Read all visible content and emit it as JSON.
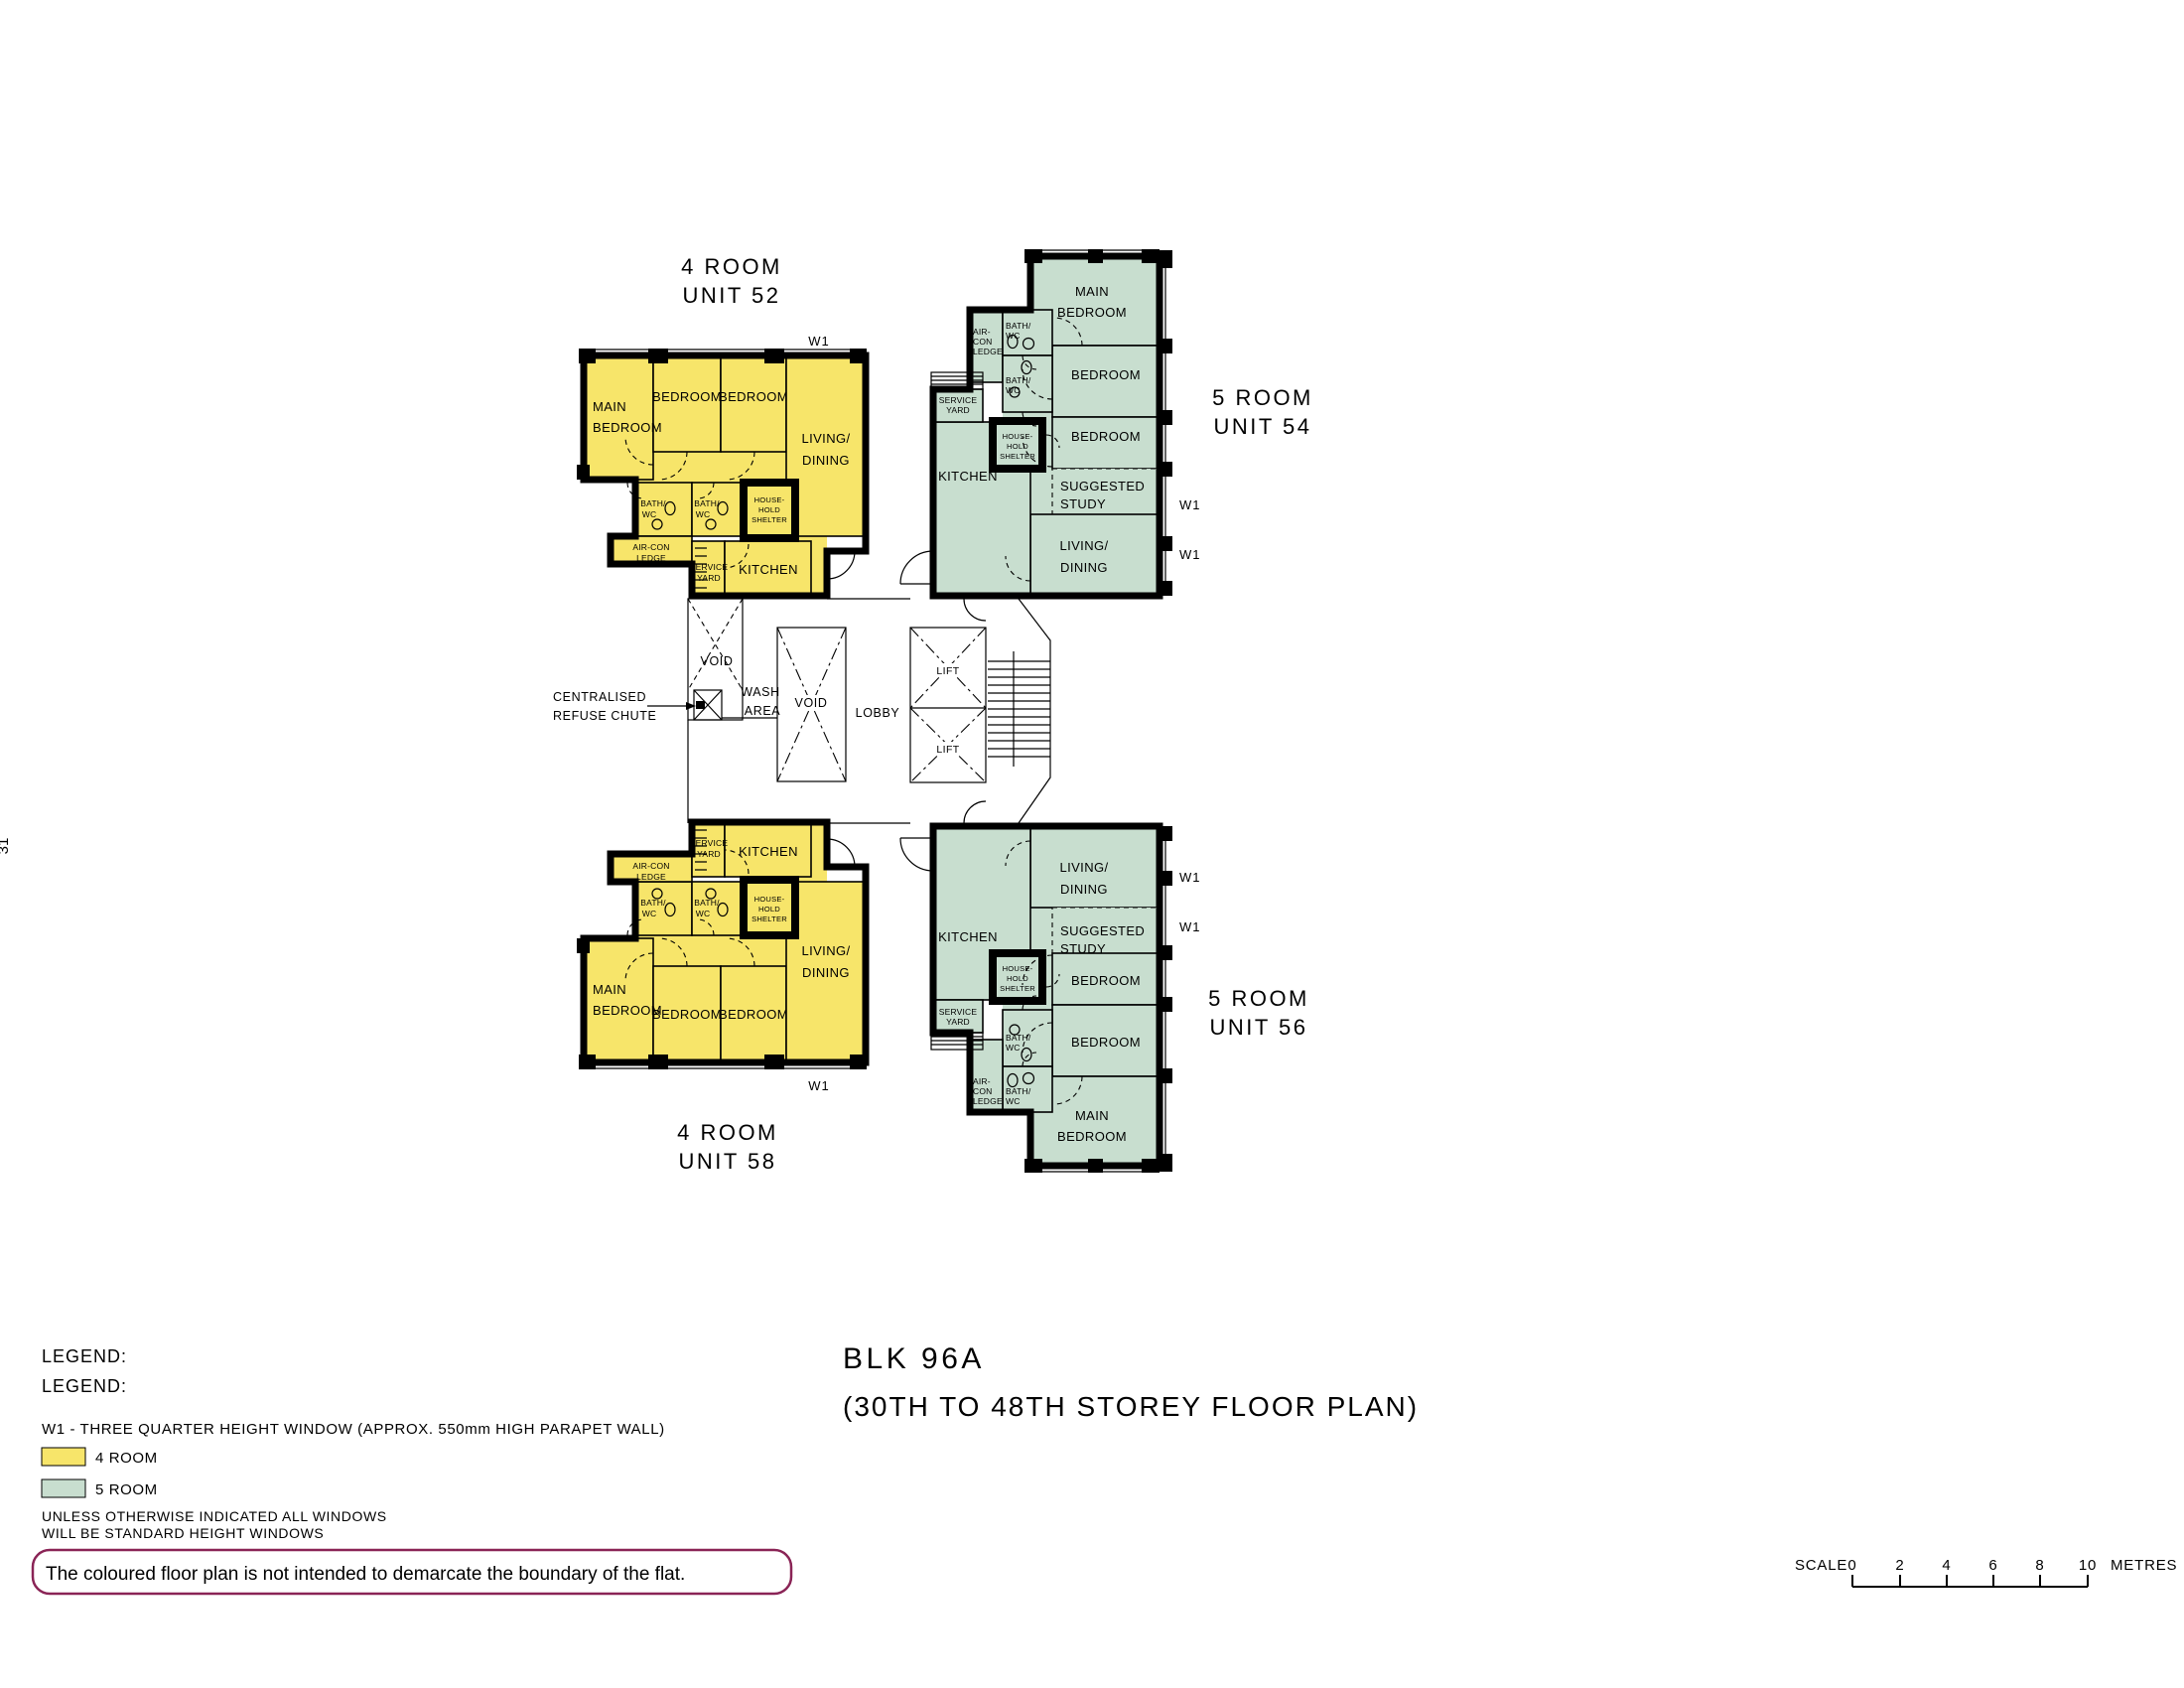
{
  "page": {
    "side_number": "31"
  },
  "colors": {
    "four_room": "#F7E56A",
    "five_room": "#C8DECF",
    "wall": "#000000",
    "note_border": "#8A2456"
  },
  "units": {
    "u52": {
      "type": "4 ROOM",
      "number": "UNIT 52",
      "window_tag": "W1",
      "rooms": {
        "main_bedroom": [
          "MAIN",
          "BEDROOM"
        ],
        "bedroom_a": "BEDROOM",
        "bedroom_b": "BEDROOM",
        "living": [
          "LIVING/",
          "DINING"
        ],
        "bath_a": [
          "BATH/",
          "WC"
        ],
        "bath_b": [
          "BATH/",
          "WC"
        ],
        "aircon": [
          "AIR-CON",
          "LEDGE"
        ],
        "shelter": [
          "HOUSE-",
          "HOLD",
          "SHELTER"
        ],
        "service": [
          "SERVICE",
          "YARD"
        ],
        "kitchen": "KITCHEN"
      }
    },
    "u58": {
      "type": "4 ROOM",
      "number": "UNIT 58",
      "window_tag": "W1",
      "rooms": {
        "main_bedroom": [
          "MAIN",
          "BEDROOM"
        ],
        "bedroom_a": "BEDROOM",
        "bedroom_b": "BEDROOM",
        "living": [
          "LIVING/",
          "DINING"
        ],
        "bath_a": [
          "BATH/",
          "WC"
        ],
        "bath_b": [
          "BATH/",
          "WC"
        ],
        "aircon": [
          "AIR-CON",
          "LEDGE"
        ],
        "shelter": [
          "HOUSE-",
          "HOLD",
          "SHELTER"
        ],
        "service": [
          "SERVICE",
          "YARD"
        ],
        "kitchen": "KITCHEN"
      }
    },
    "u54": {
      "type": "5 ROOM",
      "number": "UNIT 54",
      "window_tag_a": "W1",
      "window_tag_b": "W1",
      "rooms": {
        "main_bedroom": [
          "MAIN",
          "BEDROOM"
        ],
        "bedroom_a": "BEDROOM",
        "bedroom_b": "BEDROOM",
        "study": [
          "SUGGESTED",
          "STUDY"
        ],
        "living": [
          "LIVING/",
          "DINING"
        ],
        "kitchen": "KITCHEN",
        "service": [
          "SERVICE",
          "YARD"
        ],
        "aircon": [
          "AIR-",
          "CON",
          "LEDGE"
        ],
        "bath_a": [
          "BATH/",
          "WC"
        ],
        "bath_b": [
          "BATH/",
          "WC"
        ],
        "shelter": [
          "HOUSE-",
          "HOLD",
          "SHELTER"
        ]
      }
    },
    "u56": {
      "type": "5 ROOM",
      "number": "UNIT 56",
      "window_tag_a": "W1",
      "window_tag_b": "W1",
      "rooms": {
        "main_bedroom": [
          "MAIN",
          "BEDROOM"
        ],
        "bedroom_a": "BEDROOM",
        "bedroom_b": "BEDROOM",
        "study": [
          "SUGGESTED",
          "STUDY"
        ],
        "living": [
          "LIVING/",
          "DINING"
        ],
        "kitchen": "KITCHEN",
        "service": [
          "SERVICE",
          "YARD"
        ],
        "aircon": [
          "AIR-",
          "CON",
          "LEDGE"
        ],
        "bath_a": [
          "BATH/",
          "WC"
        ],
        "bath_b": [
          "BATH/",
          "WC"
        ],
        "shelter": [
          "HOUSE-",
          "HOLD",
          "SHELTER"
        ]
      }
    }
  },
  "core": {
    "void_a": "VOID",
    "void_b": "VOID",
    "wash": [
      "WASH",
      "AREA"
    ],
    "lobby": "LOBBY",
    "lift_a": "LIFT",
    "lift_b": "LIFT",
    "refuse_chute": [
      "CENTRALISED",
      "REFUSE CHUTE"
    ]
  },
  "legend": {
    "heading_1": "LEGEND:",
    "heading_2": "LEGEND:",
    "w1_note": "W1 -  THREE QUARTER HEIGHT WINDOW (APPROX. 550mm HIGH PARAPET WALL)",
    "items": [
      {
        "label": "4 ROOM",
        "color": "#F7E56A"
      },
      {
        "label": "5 ROOM",
        "color": "#C8DECF"
      }
    ],
    "windows_note": [
      "UNLESS OTHERWISE INDICATED ALL WINDOWS",
      "WILL BE STANDARD HEIGHT WINDOWS"
    ],
    "disclaimer": "The coloured floor plan is not intended to demarcate the boundary of the flat."
  },
  "title_block": {
    "line_1": "BLK 96A",
    "line_2": "(30TH TO 48TH STOREY FLOOR PLAN)"
  },
  "scale_bar": {
    "label": "SCALE",
    "ticks": [
      "0",
      "2",
      "4",
      "6",
      "8",
      "10"
    ],
    "unit": "METRES"
  }
}
